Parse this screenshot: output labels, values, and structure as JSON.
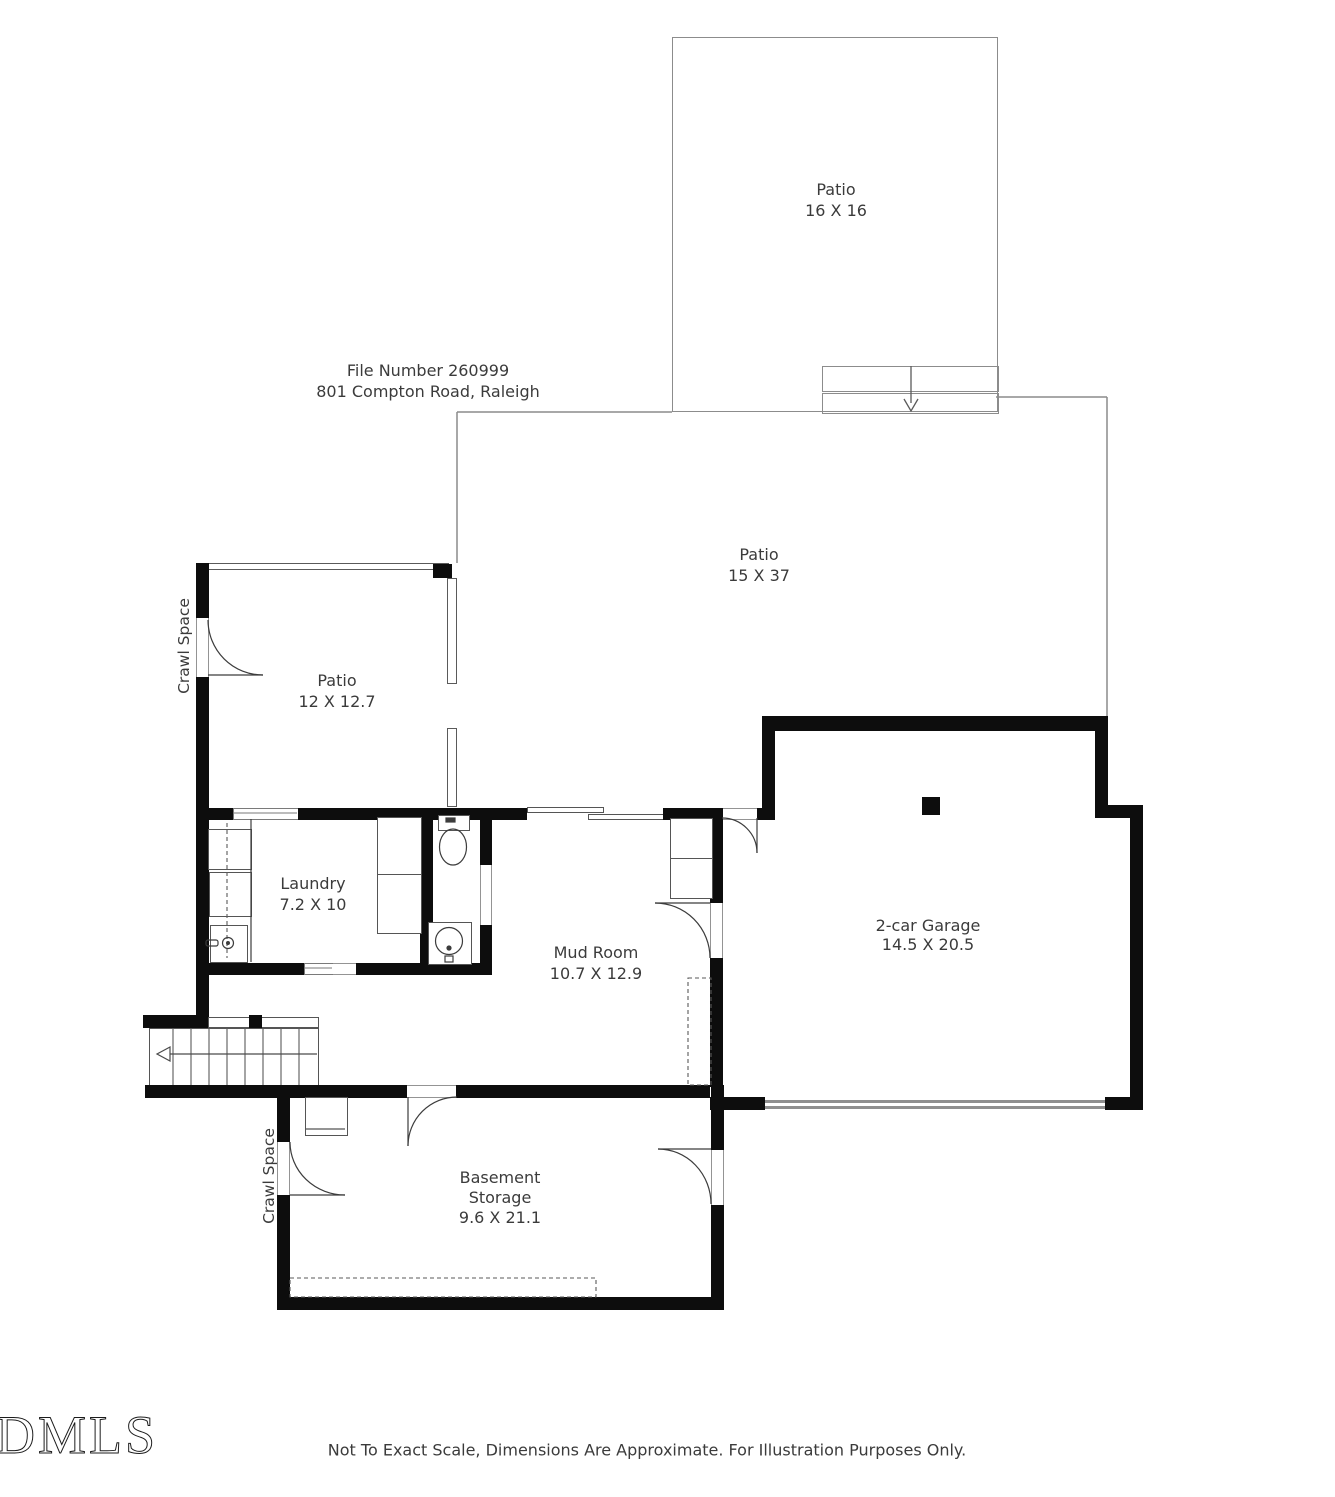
{
  "header": {
    "line1": "File Number 260999",
    "line2": "801 Compton Road, Raleigh"
  },
  "rooms": {
    "patio_upper": {
      "name": "Patio",
      "dims": "16 X 16"
    },
    "patio_main": {
      "name": "Patio",
      "dims": "15 X 37"
    },
    "patio_small": {
      "name": "Patio",
      "dims": "12 X 12.7"
    },
    "laundry": {
      "name": "Laundry",
      "dims": "7.2 X 10"
    },
    "mud_room": {
      "name": "Mud Room",
      "dims": "10.7 X 12.9"
    },
    "garage": {
      "name": "2-car Garage",
      "dims": "14.5 X 20.5"
    },
    "basement": {
      "name": "Basement",
      "name2": "Storage",
      "dims": "9.6 X 21.1"
    }
  },
  "annotations": {
    "crawl_space_left": "Crawl Space",
    "crawl_space_lower": "Crawl Space"
  },
  "footer": {
    "logo": "DMLS",
    "disclaimer": "Not To Exact Scale, Dimensions Are Approximate. For Illustration Purposes Only."
  },
  "colors": {
    "wall": "#0d0d0d",
    "thin_line": "#8c8c8c",
    "fixture_line": "#555555",
    "text": "#3b3b3b"
  }
}
